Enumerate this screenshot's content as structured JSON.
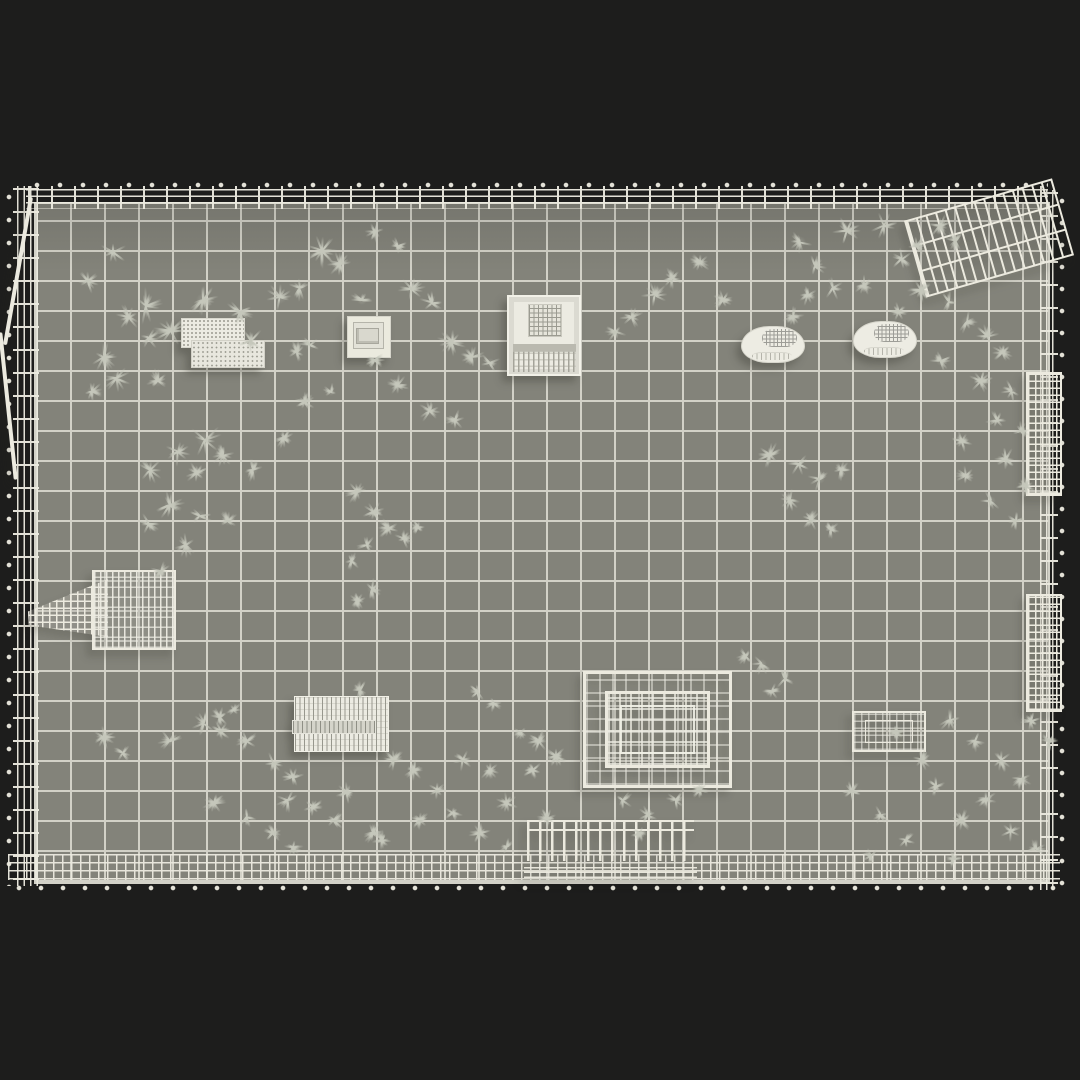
{
  "scene": {
    "description": "Top-down wireframe render of a fenced yard 3D model on a dark background",
    "colors": {
      "background": "#1d1d1c",
      "floor": "#83837a",
      "grid_line": "#d2d1c7",
      "wire": "#eceadf",
      "grass": "#c5c7bb"
    },
    "floor": {
      "x": 36,
      "y": 204,
      "width": 1012,
      "height": 678,
      "tile_width": 34,
      "tile_height": 30
    }
  },
  "props": [
    {
      "name": "vent-unit",
      "type": "ac-unit",
      "x": 181,
      "y": 318,
      "w": 88,
      "h": 50,
      "r": 0
    },
    {
      "name": "stepped-skylight-box",
      "type": "step-box",
      "x": 347,
      "y": 316,
      "w": 42,
      "h": 40,
      "r": 0
    },
    {
      "name": "mesh-crate",
      "type": "crate",
      "x": 507,
      "y": 295,
      "w": 70,
      "h": 77,
      "r": 0
    },
    {
      "name": "curved-vent-left",
      "type": "curved-vent",
      "x": 741,
      "y": 326,
      "w": 62,
      "h": 35,
      "r": 0
    },
    {
      "name": "curved-vent-right",
      "type": "curved-vent",
      "x": 853,
      "y": 321,
      "w": 62,
      "h": 35,
      "r": 0
    },
    {
      "name": "fallen-fence-panel",
      "type": "mesh-panel",
      "x": 912,
      "y": 198,
      "w": 150,
      "h": 80,
      "r": -16
    },
    {
      "name": "ramp-platform-structure",
      "type": "ramp",
      "x": 28,
      "y": 570,
      "w": 148,
      "h": 76,
      "r": 0
    },
    {
      "name": "slatted-bench",
      "type": "bench",
      "x": 294,
      "y": 696,
      "w": 93,
      "h": 54,
      "r": 0
    },
    {
      "name": "open-top-cage-container",
      "type": "cage-box",
      "x": 583,
      "y": 671,
      "w": 143,
      "h": 111,
      "r": 0
    },
    {
      "name": "small-cage-planter",
      "type": "cage-box-small",
      "x": 852,
      "y": 711,
      "w": 70,
      "h": 37,
      "r": 0
    },
    {
      "name": "railing-section",
      "type": "railing",
      "x": 527,
      "y": 820,
      "w": 167,
      "h": 50,
      "r": 0
    },
    {
      "name": "right-gate-panel-upper",
      "type": "dense-panel",
      "x": 1026,
      "y": 372,
      "w": 32,
      "h": 120,
      "r": 0
    },
    {
      "name": "right-gate-panel-lower",
      "type": "dense-panel",
      "x": 1026,
      "y": 594,
      "w": 32,
      "h": 114,
      "r": 0
    },
    {
      "name": "leaning-rail-upper",
      "type": "leaning-rail",
      "x": 16,
      "y": 196,
      "w": 4,
      "h": 150,
      "r": 10
    },
    {
      "name": "leaning-rail-lower",
      "type": "leaning-rail",
      "x": 6,
      "y": 332,
      "w": 4,
      "h": 148,
      "r": -6
    }
  ],
  "grass": [
    [
      113,
      252,
      16
    ],
    [
      88,
      281,
      14
    ],
    [
      146,
      306,
      20
    ],
    [
      129,
      317,
      14
    ],
    [
      171,
      331,
      18
    ],
    [
      104,
      357,
      16
    ],
    [
      149,
      338,
      13
    ],
    [
      117,
      378,
      15
    ],
    [
      92,
      391,
      12
    ],
    [
      158,
      381,
      14
    ],
    [
      203,
      300,
      18
    ],
    [
      240,
      312,
      16
    ],
    [
      280,
      297,
      18
    ],
    [
      300,
      288,
      14
    ],
    [
      251,
      341,
      15
    ],
    [
      297,
      352,
      13
    ],
    [
      322,
      251,
      20
    ],
    [
      340,
      264,
      14
    ],
    [
      205,
      440,
      20
    ],
    [
      178,
      452,
      16
    ],
    [
      150,
      470,
      15
    ],
    [
      197,
      473,
      14
    ],
    [
      223,
      455,
      13
    ],
    [
      170,
      505,
      16
    ],
    [
      200,
      516,
      14
    ],
    [
      149,
      524,
      13
    ],
    [
      228,
      521,
      12
    ],
    [
      186,
      545,
      13
    ],
    [
      253,
      470,
      12
    ],
    [
      284,
      438,
      11
    ],
    [
      310,
      345,
      12
    ],
    [
      362,
      300,
      13
    ],
    [
      412,
      289,
      15
    ],
    [
      432,
      303,
      13
    ],
    [
      452,
      342,
      16
    ],
    [
      472,
      357,
      14
    ],
    [
      490,
      363,
      12
    ],
    [
      430,
      411,
      14
    ],
    [
      455,
      420,
      12
    ],
    [
      398,
      385,
      12
    ],
    [
      375,
      360,
      11
    ],
    [
      305,
      402,
      11
    ],
    [
      331,
      392,
      10
    ],
    [
      375,
      232,
      11
    ],
    [
      398,
      246,
      10
    ],
    [
      357,
      492,
      13
    ],
    [
      374,
      512,
      12
    ],
    [
      389,
      528,
      13
    ],
    [
      367,
      545,
      11
    ],
    [
      352,
      561,
      10
    ],
    [
      404,
      539,
      11
    ],
    [
      418,
      527,
      10
    ],
    [
      372,
      589,
      12
    ],
    [
      358,
      601,
      10
    ],
    [
      616,
      332,
      12
    ],
    [
      632,
      317,
      13
    ],
    [
      655,
      295,
      15
    ],
    [
      672,
      278,
      13
    ],
    [
      700,
      262,
      12
    ],
    [
      723,
      300,
      11
    ],
    [
      833,
      288,
      13
    ],
    [
      800,
      242,
      14
    ],
    [
      815,
      266,
      13
    ],
    [
      808,
      295,
      12
    ],
    [
      793,
      316,
      12
    ],
    [
      847,
      231,
      16
    ],
    [
      884,
      226,
      15
    ],
    [
      902,
      259,
      13
    ],
    [
      917,
      246,
      12
    ],
    [
      940,
      226,
      14
    ],
    [
      956,
      241,
      12
    ],
    [
      921,
      290,
      14
    ],
    [
      949,
      302,
      13
    ],
    [
      967,
      322,
      14
    ],
    [
      987,
      336,
      13
    ],
    [
      1003,
      352,
      12
    ],
    [
      941,
      361,
      12
    ],
    [
      981,
      381,
      13
    ],
    [
      1012,
      391,
      12
    ],
    [
      997,
      420,
      13
    ],
    [
      1021,
      431,
      11
    ],
    [
      962,
      441,
      12
    ],
    [
      1006,
      459,
      12
    ],
    [
      1026,
      486,
      11
    ],
    [
      991,
      501,
      12
    ],
    [
      1016,
      521,
      11
    ],
    [
      966,
      476,
      11
    ],
    [
      899,
      312,
      12
    ],
    [
      864,
      285,
      11
    ],
    [
      770,
      455,
      14
    ],
    [
      799,
      464,
      13
    ],
    [
      820,
      479,
      13
    ],
    [
      790,
      500,
      12
    ],
    [
      811,
      519,
      12
    ],
    [
      841,
      470,
      11
    ],
    [
      831,
      529,
      10
    ],
    [
      762,
      664,
      13
    ],
    [
      785,
      679,
      12
    ],
    [
      772,
      691,
      11
    ],
    [
      746,
      656,
      11
    ],
    [
      539,
      741,
      13
    ],
    [
      556,
      756,
      12
    ],
    [
      521,
      733,
      11
    ],
    [
      478,
      692,
      11
    ],
    [
      494,
      703,
      10
    ],
    [
      161,
      571,
      11
    ],
    [
      360,
      690,
      11
    ],
    [
      104,
      737,
      13
    ],
    [
      123,
      753,
      12
    ],
    [
      170,
      741,
      14
    ],
    [
      204,
      723,
      13
    ],
    [
      221,
      731,
      12
    ],
    [
      247,
      741,
      13
    ],
    [
      214,
      803,
      13
    ],
    [
      247,
      817,
      12
    ],
    [
      288,
      800,
      13
    ],
    [
      313,
      807,
      12
    ],
    [
      334,
      820,
      12
    ],
    [
      373,
      833,
      12
    ],
    [
      220,
      717,
      11
    ],
    [
      234,
      710,
      10
    ],
    [
      273,
      763,
      13
    ],
    [
      293,
      777,
      12
    ],
    [
      347,
      793,
      12
    ],
    [
      394,
      760,
      13
    ],
    [
      414,
      770,
      12
    ],
    [
      437,
      790,
      12
    ],
    [
      463,
      760,
      13
    ],
    [
      490,
      770,
      12
    ],
    [
      507,
      803,
      12
    ],
    [
      533,
      770,
      12
    ],
    [
      480,
      833,
      12
    ],
    [
      507,
      847,
      11
    ],
    [
      453,
      813,
      11
    ],
    [
      293,
      847,
      11
    ],
    [
      273,
      833,
      10
    ],
    [
      382,
      840,
      11
    ],
    [
      420,
      820,
      11
    ],
    [
      623,
      800,
      12
    ],
    [
      648,
      815,
      11
    ],
    [
      676,
      800,
      11
    ],
    [
      640,
      833,
      10
    ],
    [
      700,
      790,
      10
    ],
    [
      547,
      818,
      11
    ],
    [
      950,
      720,
      14
    ],
    [
      975,
      741,
      13
    ],
    [
      1001,
      760,
      13
    ],
    [
      1021,
      779,
      12
    ],
    [
      986,
      799,
      12
    ],
    [
      962,
      820,
      12
    ],
    [
      1011,
      831,
      11
    ],
    [
      1036,
      849,
      11
    ],
    [
      953,
      859,
      10
    ],
    [
      1031,
      721,
      11
    ],
    [
      1049,
      741,
      10
    ],
    [
      852,
      791,
      12
    ],
    [
      881,
      815,
      12
    ],
    [
      906,
      840,
      11
    ],
    [
      871,
      856,
      10
    ],
    [
      936,
      786,
      11
    ],
    [
      922,
      760,
      11
    ],
    [
      896,
      732,
      10
    ]
  ]
}
